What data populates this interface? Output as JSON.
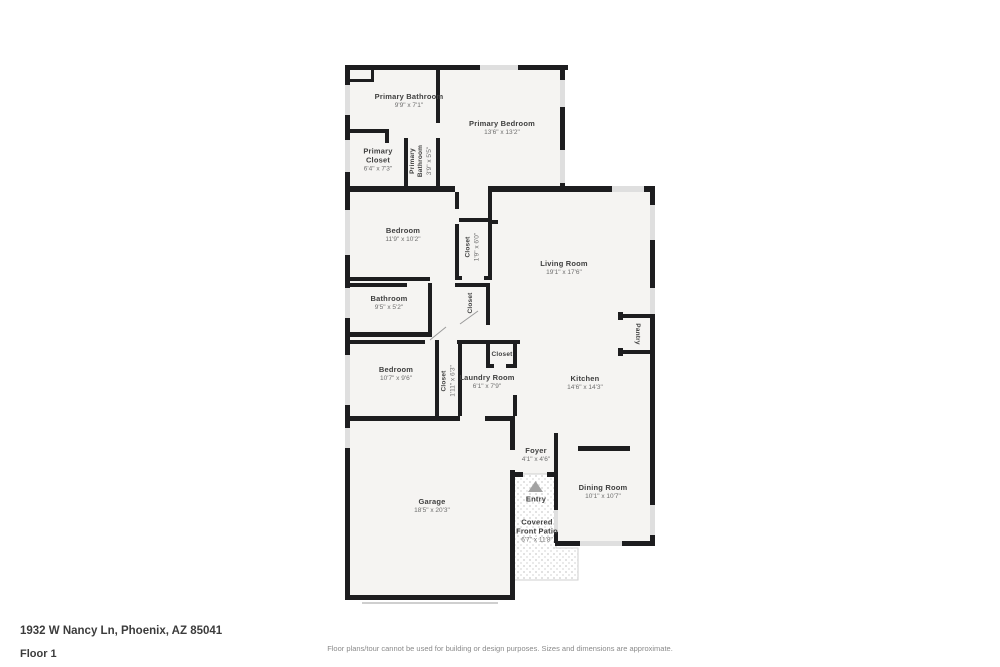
{
  "footer": {
    "address": "1932 W Nancy Ln, Phoenix, AZ 85041",
    "floor_label": "Floor 1",
    "disclaimer": "Floor plans/tour cannot be used for building or design purposes. Sizes and dimensions are approximate."
  },
  "colors": {
    "wall": "#1d1d1f",
    "room": "#f5f4f2",
    "window": "#dfdfdf",
    "outside": "#ffffff",
    "ink": "#3f3f3f",
    "muted": "#6e6e6e"
  },
  "rooms": {
    "primary_bathroom": {
      "name": "Primary Bathroom",
      "dims": "9'9\" x 7'1\""
    },
    "primary_bedroom": {
      "name": "Primary Bedroom",
      "dims": "13'6\" x 13'2\""
    },
    "primary_closet": {
      "name": "Primary Closet",
      "dims": "6'4\" x 7'3\""
    },
    "primary_bathroom_small": {
      "name": "Primary Bathroom",
      "dims": "3'9\" x 5'5\""
    },
    "bedroom_2": {
      "name": "Bedroom",
      "dims": "11'9\" x 10'2\""
    },
    "hall_closet": {
      "name": "Closet",
      "dims": "1'9\" x 6'0\""
    },
    "living_room": {
      "name": "Living Room",
      "dims": "19'1\" x 17'6\""
    },
    "bathroom": {
      "name": "Bathroom",
      "dims": "9'5\" x 5'2\""
    },
    "bath_hall_closet": {
      "name": "Closet"
    },
    "bedroom_3": {
      "name": "Bedroom",
      "dims": "10'7\" x 9'6\""
    },
    "bedroom_3_closet": {
      "name": "Closet",
      "dims": "1'11\" x 6'3\""
    },
    "laundry_room": {
      "name": "Laundry Room",
      "dims": "6'1\" x 7'9\""
    },
    "laundry_closet": {
      "name": "Closet"
    },
    "kitchen": {
      "name": "Kitchen",
      "dims": "14'6\" x 14'3\""
    },
    "pantry": {
      "name": "Pantry"
    },
    "foyer": {
      "name": "Foyer",
      "dims": "4'1\" x 4'6\""
    },
    "entry": {
      "name": "Entry"
    },
    "dining_room": {
      "name": "Dining Room",
      "dims": "10'1\" x 10'7\""
    },
    "covered_front_patio": {
      "name": "Covered Front Patio",
      "dims": "6'7\" x 11'8\""
    },
    "garage": {
      "name": "Garage",
      "dims": "18'5\" x 20'3\""
    }
  }
}
